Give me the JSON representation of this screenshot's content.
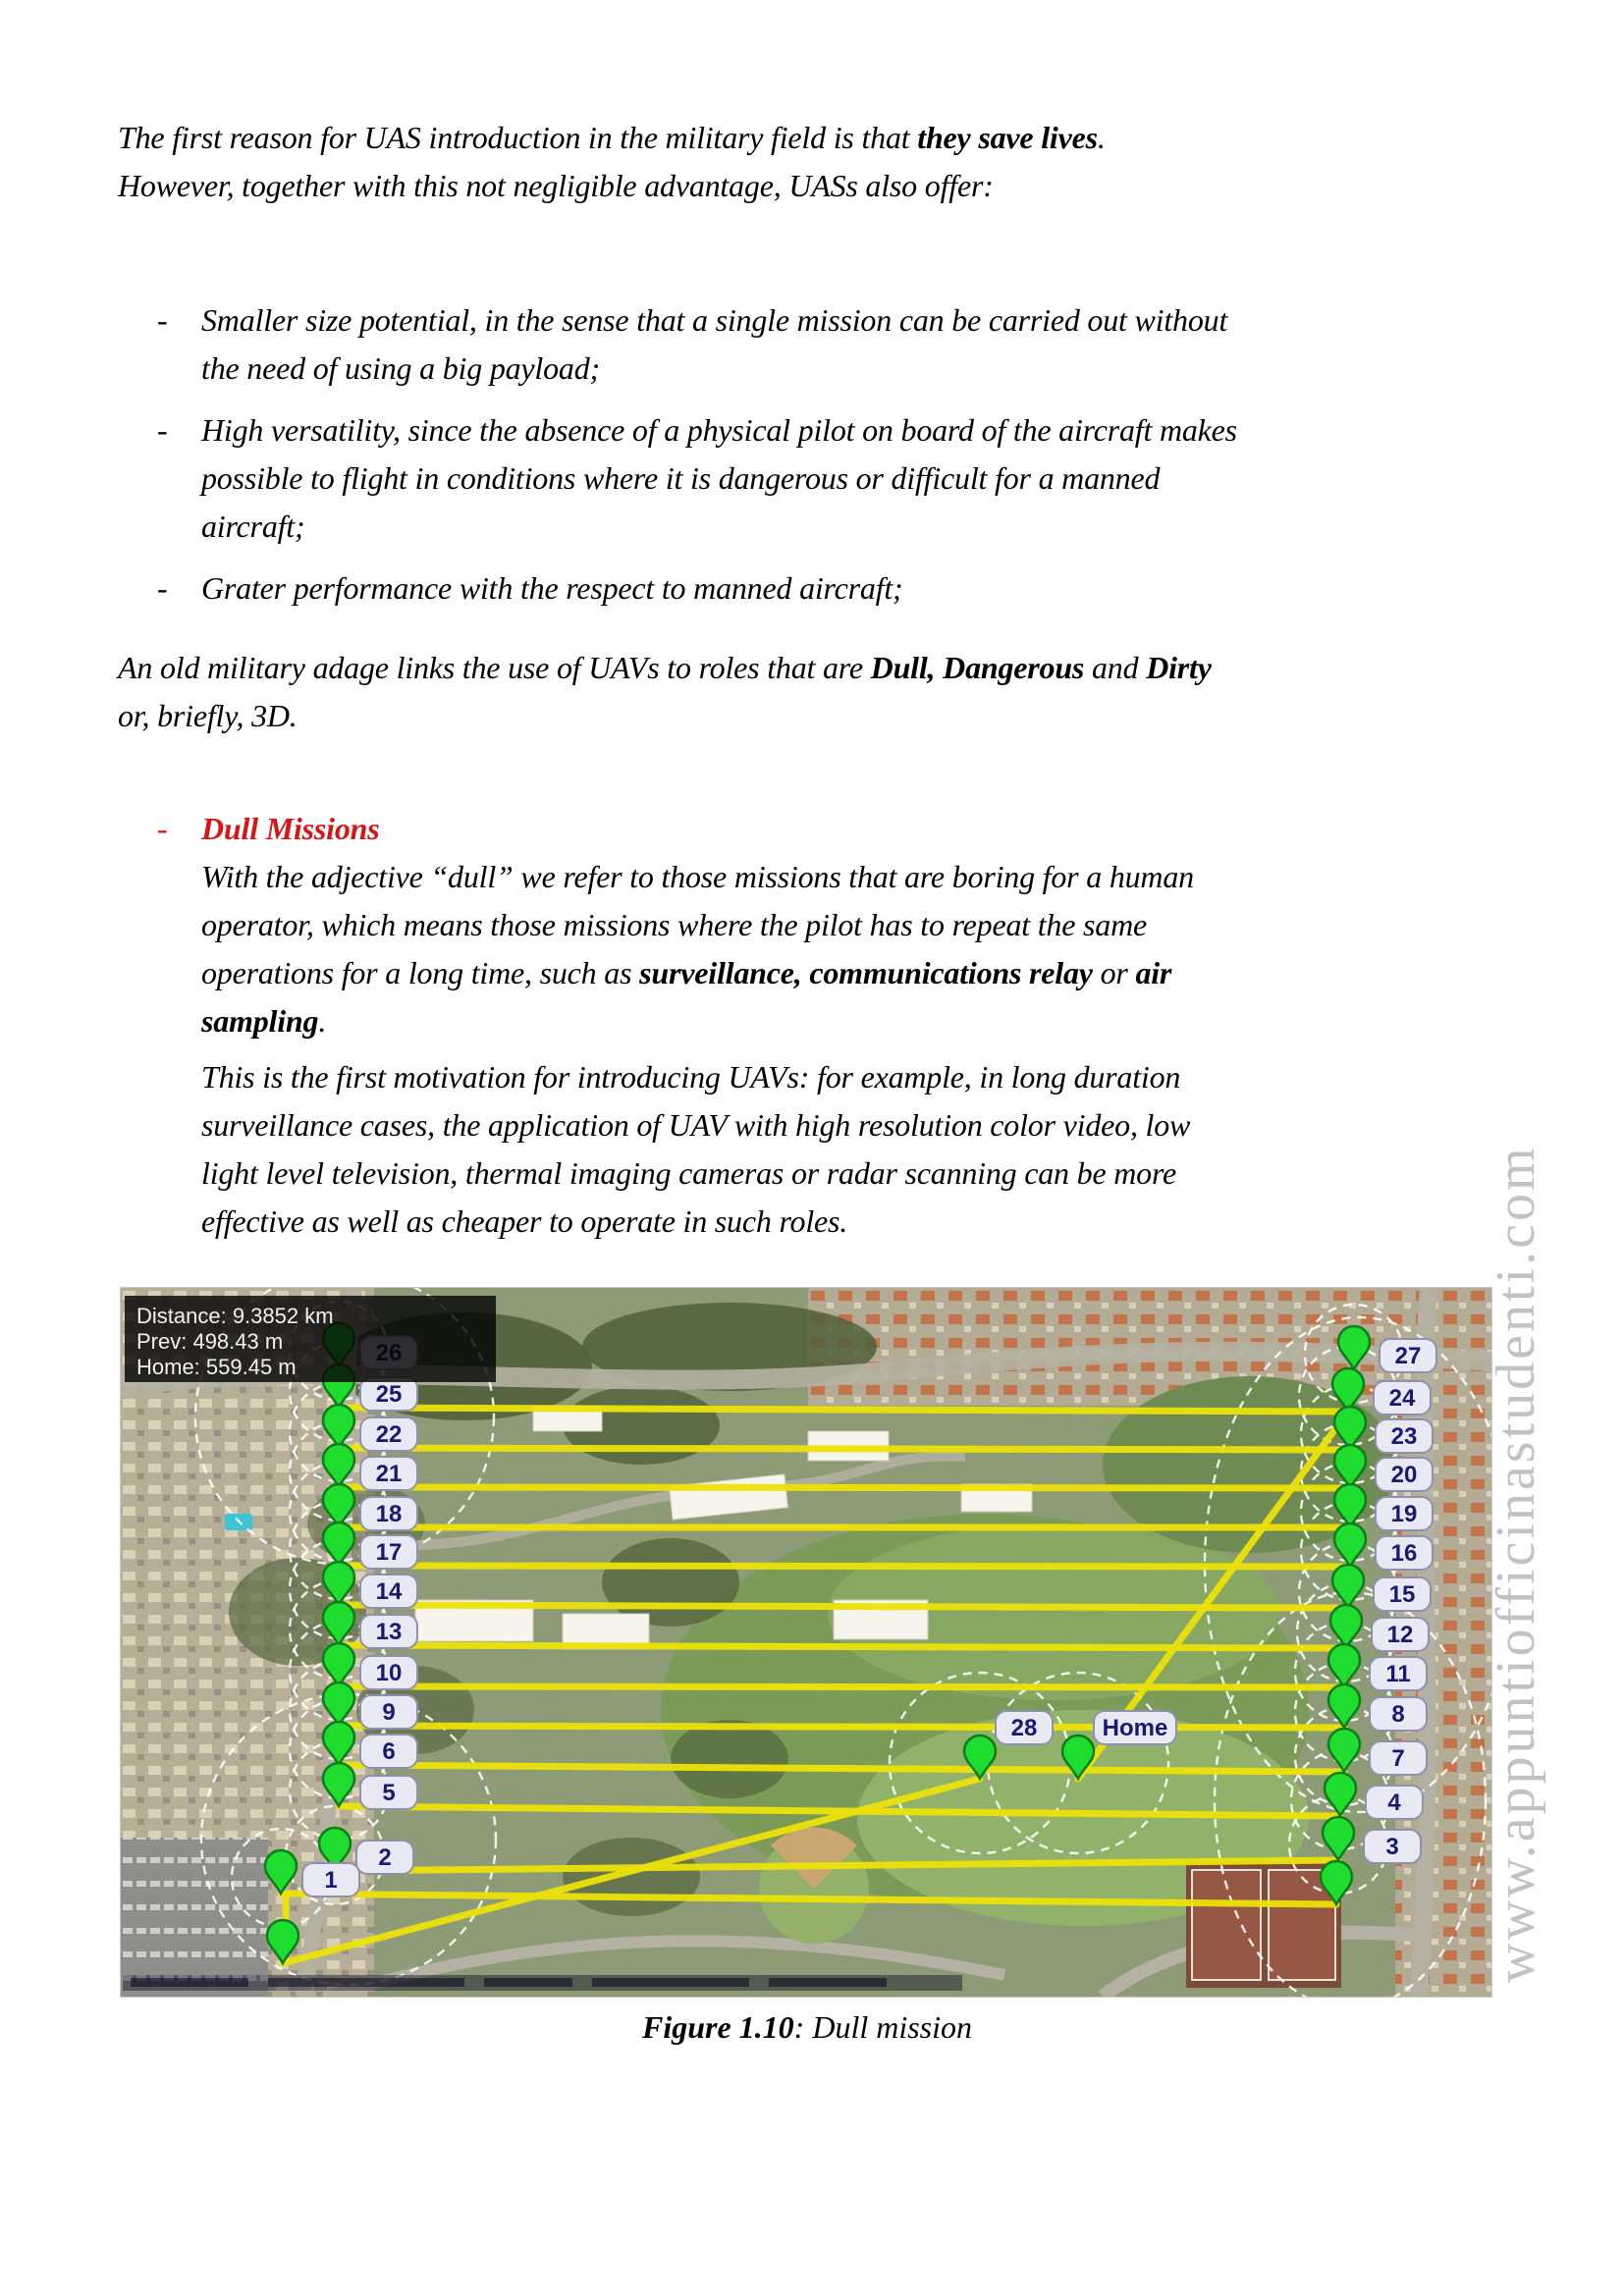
{
  "list_dash": "-",
  "intro": {
    "runs": [
      {
        "t": "The first reason for UAS introduction in the military field is that "
      },
      {
        "t": "they save lives",
        "b": 1
      },
      {
        "t": ".",
        "br": 1
      },
      {
        "t": "However, together with this not negligible advantage, UASs also offer:"
      }
    ]
  },
  "bullets": [
    {
      "runs": [
        {
          "t": "Smaller size potential, in the sense that a single mission can be carried out without",
          "br": 1
        },
        {
          "t": "the need of using a big payload;"
        }
      ]
    },
    {
      "runs": [
        {
          "t": "High versatility, since the absence of a physical pilot on board of the aircraft makes",
          "br": 1
        },
        {
          "t": "possible to flight in conditions where it is dangerous or difficult for a manned",
          "br": 1
        },
        {
          "t": "aircraft;"
        }
      ]
    },
    {
      "runs": [
        {
          "t": "Grater performance with the respect to manned aircraft;"
        }
      ]
    }
  ],
  "adage": {
    "runs": [
      {
        "t": "An old military adage links the use of UAVs to roles that are "
      },
      {
        "t": "Dull, Dangerous",
        "b": 1
      },
      {
        "t": " and "
      },
      {
        "t": "Dirty",
        "b": 1,
        "br": 1
      },
      {
        "t": "or, briefly, 3D."
      }
    ]
  },
  "dull_section": {
    "heading": "Dull Missions",
    "heading_color": "#d81414",
    "para1_runs": [
      {
        "t": "With the adjective “dull” we refer to those missions that are boring for a human",
        "br": 1
      },
      {
        "t": "operator, which means those missions where the pilot has to repeat the same",
        "br": 1
      },
      {
        "t": "operations for a long time, such as "
      },
      {
        "t": "surveillance, communications relay",
        "b": 1
      },
      {
        "t": " or "
      },
      {
        "t": "air",
        "b": 1,
        "br": 1
      },
      {
        "t": "sampling",
        "b": 1
      },
      {
        "t": "."
      }
    ],
    "para2_runs": [
      {
        "t": "This is the first motivation for introducing UAVs: for example, in long duration",
        "br": 1
      },
      {
        "t": "surveillance cases, the application of UAV with high resolution color video, low",
        "br": 1
      },
      {
        "t": "light level television, thermal imaging cameras or radar scanning can be more",
        "br": 1
      },
      {
        "t": "effective as well as cheaper to operate in such roles."
      }
    ]
  },
  "figure": {
    "caption_runs": [
      {
        "t": "Figure 1.10",
        "b": 1
      },
      {
        "t": ": Dull mission"
      }
    ],
    "map": {
      "info_box": {
        "lines": [
          "Distance: 9.3852 km",
          "Prev: 498.43 m",
          "Home: 559.45 m"
        ]
      },
      "colors": {
        "route": "#ece20a",
        "pin_fill": "#1fdd2e",
        "pin_stroke": "#0c7d18",
        "pill_text": "#191970"
      },
      "loiter_radius": 50,
      "left_waypoints": [
        {
          "label": "26",
          "px": 222,
          "py": 80
        },
        {
          "label": "25",
          "px": 222,
          "py": 122
        },
        {
          "label": "22",
          "px": 222,
          "py": 163
        },
        {
          "label": "21",
          "px": 222,
          "py": 203
        },
        {
          "label": "18",
          "px": 222,
          "py": 244
        },
        {
          "label": "17",
          "px": 222,
          "py": 283
        },
        {
          "label": "14",
          "px": 222,
          "py": 323
        },
        {
          "label": "13",
          "px": 222,
          "py": 364
        },
        {
          "label": "10",
          "px": 222,
          "py": 406
        },
        {
          "label": "9",
          "px": 222,
          "py": 446
        },
        {
          "label": "6",
          "px": 222,
          "py": 486
        },
        {
          "label": "5",
          "px": 222,
          "py": 528
        },
        {
          "label": "2",
          "px": 218,
          "py": 594
        },
        {
          "label": "1",
          "px": 163,
          "py": 617
        }
      ],
      "right_waypoints": [
        {
          "label": "27",
          "px": 1256,
          "py": 83
        },
        {
          "label": "24",
          "px": 1250,
          "py": 126
        },
        {
          "label": "23",
          "px": 1252,
          "py": 165
        },
        {
          "label": "20",
          "px": 1252,
          "py": 204
        },
        {
          "label": "19",
          "px": 1252,
          "py": 244
        },
        {
          "label": "16",
          "px": 1252,
          "py": 284
        },
        {
          "label": "15",
          "px": 1250,
          "py": 326
        },
        {
          "label": "12",
          "px": 1248,
          "py": 367
        },
        {
          "label": "11",
          "px": 1246,
          "py": 407
        },
        {
          "label": "8",
          "px": 1246,
          "py": 448
        },
        {
          "label": "7",
          "px": 1246,
          "py": 493
        },
        {
          "label": "4",
          "px": 1242,
          "py": 538
        },
        {
          "label": "3",
          "px": 1240,
          "py": 583
        }
      ],
      "center_waypoints": [
        {
          "label": "28",
          "px": 875,
          "py": 500,
          "r": 92
        },
        {
          "label": "Home",
          "px": 975,
          "py": 500,
          "r": 92
        }
      ],
      "extra_pins": [
        {
          "px": 165,
          "py": 688
        },
        {
          "px": 1238,
          "py": 628
        }
      ],
      "big_ellipses": [
        [
          228,
          132,
          152,
          150
        ],
        [
          232,
          562,
          150,
          148
        ],
        [
          1262,
          282,
          158,
          252
        ],
        [
          1252,
          522,
          138,
          212
        ]
      ],
      "routes": [
        [
          222,
          122,
          1250,
          126
        ],
        [
          222,
          163,
          1252,
          165
        ],
        [
          222,
          203,
          1252,
          204
        ],
        [
          222,
          244,
          1252,
          244
        ],
        [
          222,
          283,
          1252,
          284
        ],
        [
          222,
          323,
          1250,
          326
        ],
        [
          222,
          364,
          1248,
          367
        ],
        [
          222,
          406,
          1246,
          407
        ],
        [
          222,
          446,
          1246,
          448
        ],
        [
          222,
          486,
          1246,
          493
        ],
        [
          222,
          528,
          1242,
          538
        ],
        [
          218,
          594,
          1240,
          583
        ],
        [
          163,
          617,
          1238,
          628
        ],
        [
          975,
          500,
          1250,
          126
        ],
        [
          165,
          688,
          875,
          500
        ],
        [
          168,
          620,
          168,
          648
        ]
      ]
    }
  },
  "watermark": {
    "text": "www.appuntiofficinastudenti.com"
  }
}
